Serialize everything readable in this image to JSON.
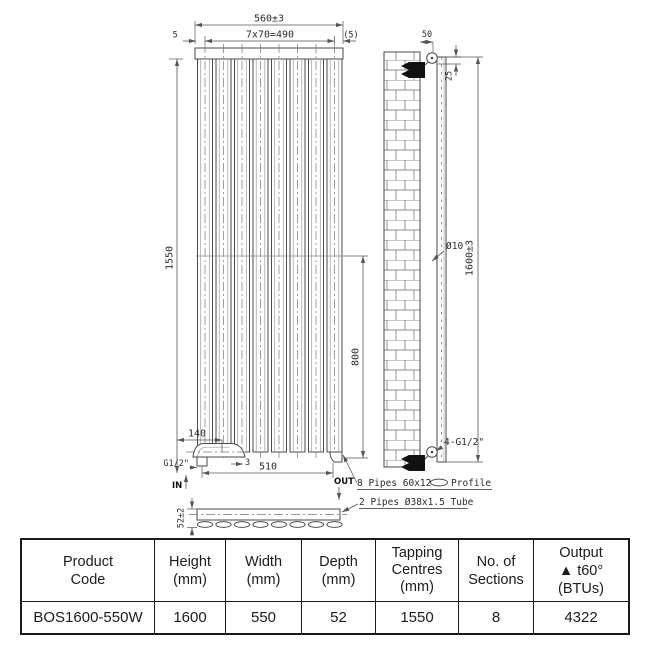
{
  "colors": {
    "background": "#ffffff",
    "outline": "#4a4a4a",
    "dim_line": "#555555",
    "drawing_text": "#2b2b2b",
    "bolt_fill": "#111111",
    "table_border": "#1a1a1a",
    "table_text": "#1c1c1c"
  },
  "drawing": {
    "front": {
      "overall_width": "560±3",
      "panel_pitch": "7x70=490",
      "edge_gap_left": "5",
      "edge_gap_right": "(5)",
      "tapping_height": "1550",
      "lower_span": "800",
      "valve_offset": "140",
      "gap_small": "3",
      "bottom_centres": "510",
      "thread_size": "G1/2\"",
      "inlet_label": "IN",
      "outlet_label": "OUT"
    },
    "side": {
      "bracket_depth": "50",
      "top_offset": "25",
      "hole_diameter": "Ø10",
      "overall_height": "1600±3",
      "connections": "4-G1/2\""
    },
    "section": {
      "depth": "52±2",
      "profile_note_prefix": "8 Pipes 60x12",
      "profile_note_suffix": "Profile",
      "tube_note": "2 Pipes Ø38x1.5 Tube"
    }
  },
  "table": {
    "headers": [
      {
        "l1": "Product",
        "l2": "Code",
        "l3": ""
      },
      {
        "l1": "Height",
        "l2": "(mm)",
        "l3": ""
      },
      {
        "l1": "Width",
        "l2": "(mm)",
        "l3": ""
      },
      {
        "l1": "Depth",
        "l2": "(mm)",
        "l3": ""
      },
      {
        "l1": "Tapping",
        "l2": "Centres",
        "l3": "(mm)"
      },
      {
        "l1": "No. of",
        "l2": "Sections",
        "l3": ""
      },
      {
        "l1": "Output",
        "l2": "▲ t60° (BTUs)",
        "l3": ""
      }
    ],
    "row": [
      "BOS1600-550W",
      "1600",
      "550",
      "52",
      "1550",
      "8",
      "4322"
    ]
  }
}
